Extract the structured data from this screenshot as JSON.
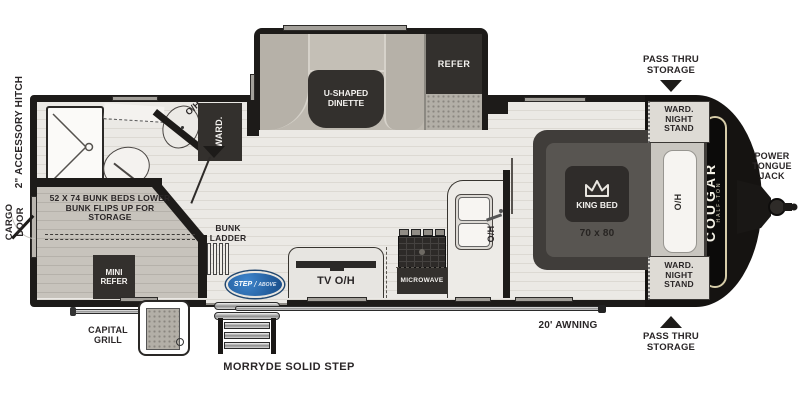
{
  "exterior": {
    "pass_thru_storage_top": "PASS THRU STORAGE",
    "pass_thru_storage_bottom": "PASS THRU STORAGE",
    "power_tongue_jack": "POWER TONGUE JACK",
    "accessory_hitch": "2\" ACCESSORY HITCH",
    "cargo_door": "CARGO DOOR",
    "capital_grill": "CAPITAL GRILL",
    "morryde_step": "MORRYDE SOLID STEP",
    "awning": "20' AWNING"
  },
  "front_cap": {
    "brand": "COUGAR",
    "brand_sub": "HALF-TON"
  },
  "bedroom": {
    "king_bed": "KING BED",
    "size": "70 x 80",
    "oh": "O/H",
    "ward_nightstand_top": "WARD. NIGHT STAND",
    "ward_nightstand_bottom": "WARD. NIGHT STAND"
  },
  "kitchen": {
    "tv_oh": "TV O/H",
    "microwave": "MICROWAVE",
    "oh": "O/H",
    "sink_oh": "O/H"
  },
  "dinette_slide": {
    "dinette": "U-SHAPED DINETTE",
    "refer": "REFER"
  },
  "bathroom": {
    "ward": "WARD.",
    "oh": "O/H"
  },
  "bunk_room": {
    "note": "52 X 74 BUNK BEDS LOWER BUNK FLIPS UP FOR STORAGE",
    "mini_refer": "MINI REFER",
    "bunk_ladder": "BUNK LADDER"
  },
  "entry": {
    "step_brand_1": "STEP",
    "step_brand_2": "ABOVE"
  },
  "colors": {
    "wall": "#1d1b19",
    "floor": "#ebe9e5",
    "bench": "#beb9b0",
    "dark_fixture": "#33302d",
    "logo_blue": "#2a6db5",
    "cap_cream": "#d6cca8"
  }
}
